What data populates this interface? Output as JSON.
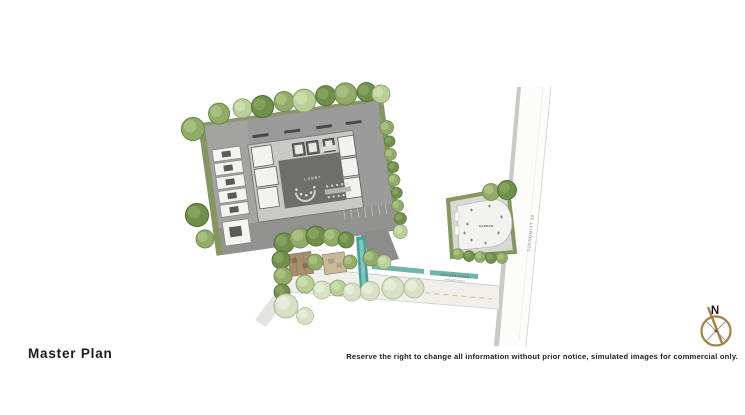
{
  "titles": {
    "page_title": "Master Plan"
  },
  "footer": {
    "disclaimer": "Reserve the right to change all information without prior notice, simulated images for commercial only."
  },
  "plan": {
    "lobby_label": "LOBBY",
    "garden_label": "GARDEN",
    "access_road_label": "ACCESS ROAD",
    "access_road_subtitle": "(PRIVATE ROAD)",
    "side_road_label": "SUKHUMVIT 39"
  },
  "compass": {
    "north_label": "N"
  },
  "colors": {
    "site_gray": "#9b9b9b",
    "lobby_dark": "#6e6e6a",
    "olive_border": "#87965e",
    "tree_dark": "#6f8f4a",
    "tree_mid": "#92ab68",
    "tree_light": "#b9cf97",
    "tree_pale": "#d8e1c6",
    "pool_teal": "#46a39c",
    "road_surface": "#f0efec",
    "compass_tan": "#a5803c",
    "text_dark": "#1a1a1a"
  }
}
